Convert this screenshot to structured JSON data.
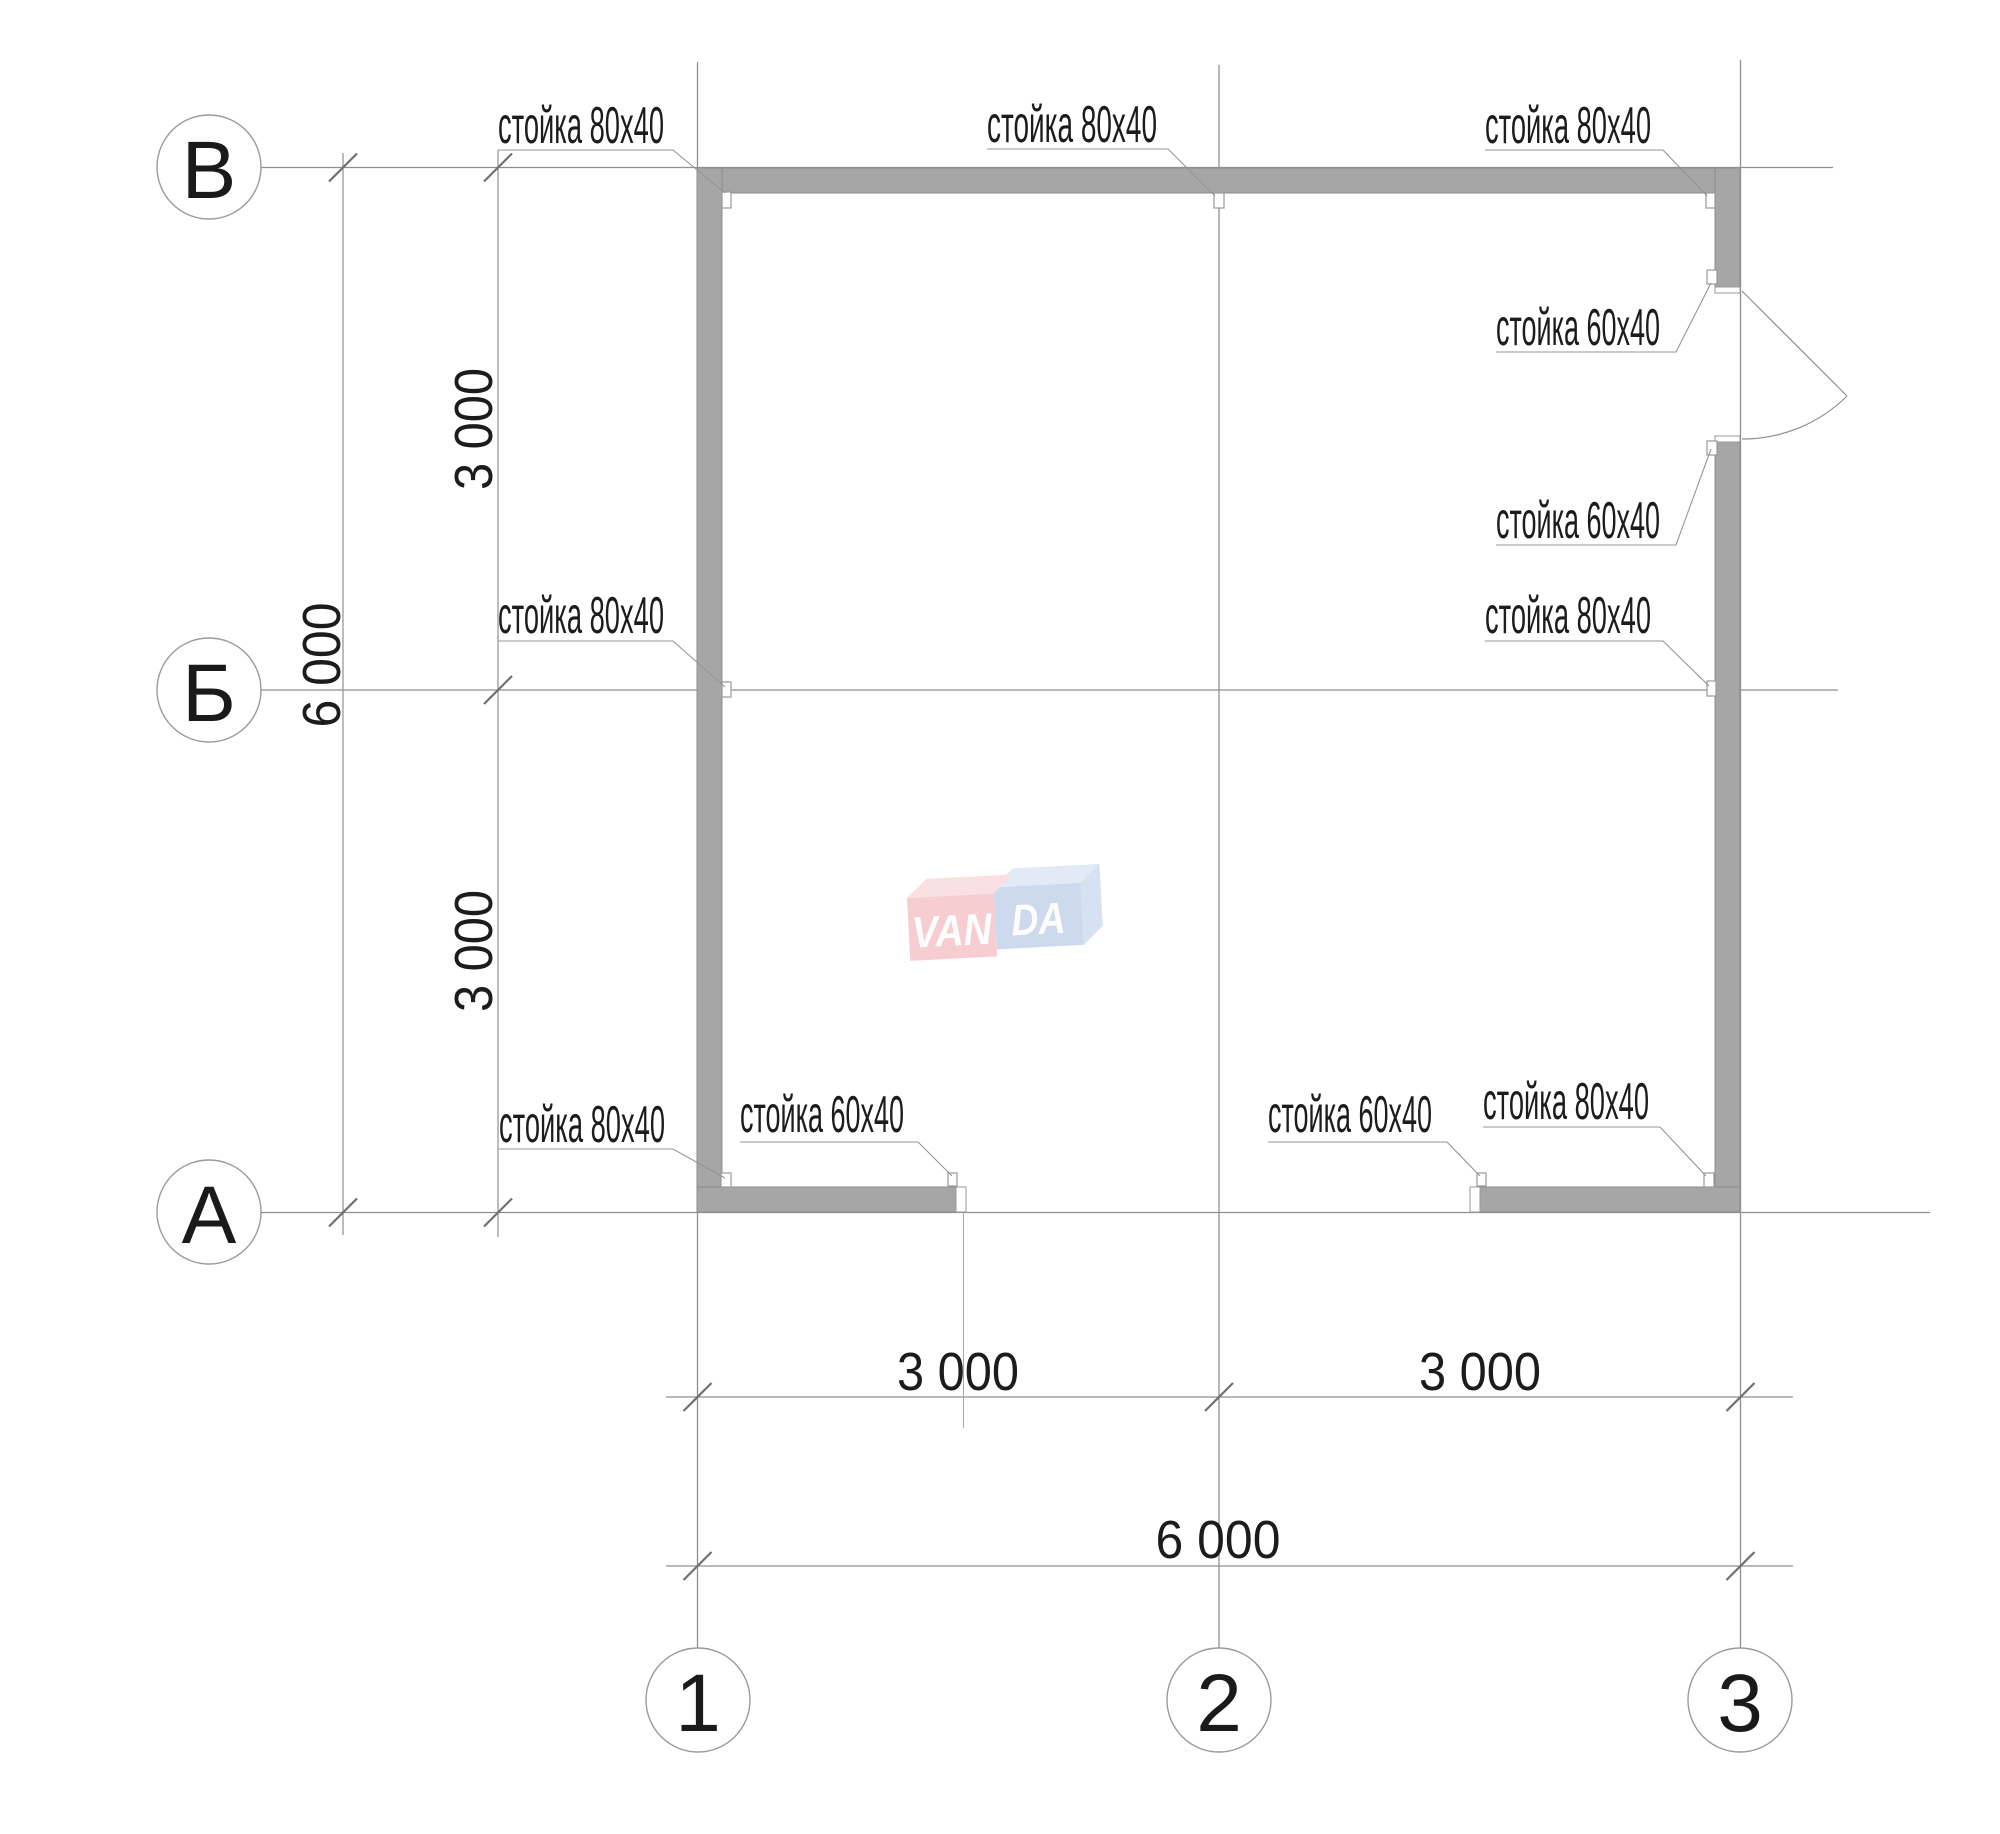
{
  "axes": {
    "rows": [
      {
        "label": "В"
      },
      {
        "label": "Б"
      },
      {
        "label": "А"
      }
    ],
    "cols": [
      {
        "label": "1"
      },
      {
        "label": "2"
      },
      {
        "label": "3"
      }
    ]
  },
  "dimensions": {
    "left_upper": "3 000",
    "left_total": "6 000",
    "left_lower": "3 000",
    "bottom_left": "3 000",
    "bottom_right": "3 000",
    "bottom_total": "6 000"
  },
  "stud_labels": {
    "top_left": "стойка 80х40",
    "top_middle": "стойка 80х40",
    "top_right": "стойка 80х40",
    "door_upper": "стойка 60х40",
    "door_lower": "стойка 60х40",
    "middle_left": "стойка 80х40",
    "middle_right": "стойка 80х40",
    "bottom_left_corner": "стойка 80х40",
    "bottom_opening_left": "стойка 60х40",
    "bottom_opening_right": "стойка 60х40",
    "bottom_right_corner": "стойка 80х40"
  },
  "watermark": {
    "left_text": "VAN",
    "right_text": "DA"
  },
  "colors": {
    "wall_fill": "#a6a6a6",
    "line": "#8f8f8f",
    "text": "#1c1c1c",
    "logo_pink_front": "#f5c6ca",
    "logo_pink_top": "#f9dbde",
    "logo_blue_front": "#c5d4ea",
    "logo_blue_top": "#dce7f5",
    "logo_blue_side": "#cfdef0",
    "logo_text": "#fdfdfd"
  }
}
